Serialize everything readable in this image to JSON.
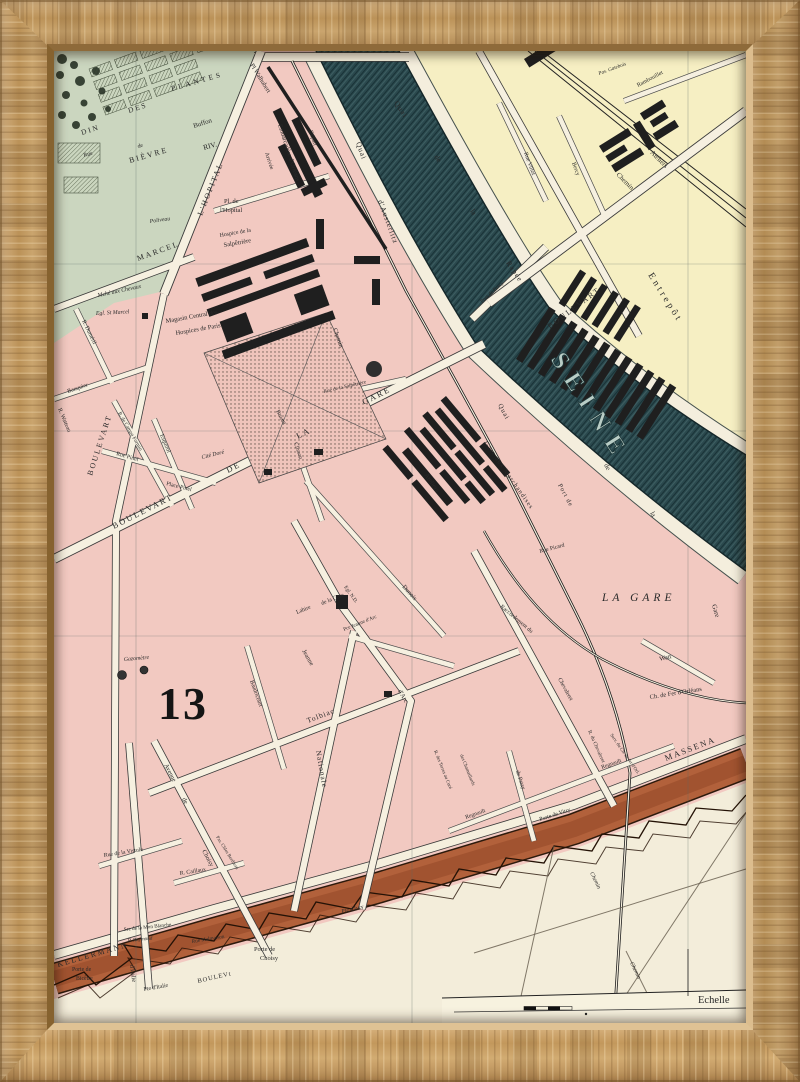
{
  "product": {
    "type": "framed antique map print",
    "frame_wood_color": "#c2a06c"
  },
  "map": {
    "colors": {
      "district_pink": "#f2c9c1",
      "garden_green": "#cbd6bf",
      "right_bank_yellow": "#f6efc3",
      "river_dark": "#2a484d",
      "street_cream": "#f6f0e0",
      "fortification_rust": "#b2613b",
      "zone_cream": "#f3edda",
      "building_black": "#1f1f1f"
    },
    "labels": {
      "din": "DIN",
      "des": "DES",
      "plantes": "PLANTES",
      "rue": "Rue",
      "de": "de",
      "la": "la",
      "buffon": "Buffon",
      "bievre": "BIÈVRE",
      "riv": "RIV.",
      "poliveau": "Poliveau",
      "marcel": "MARCEL",
      "egl_st_marcel": "Egl. St Marcel",
      "marche_chevaux": "Mché aux Chevaux",
      "pl_de": "Pl. de",
      "l_hopital": "l'Hopital",
      "bd_hopital": "L'HOPITAL",
      "pl_walhubert": "Pl Walhubert",
      "embarcadere": "Embarcadère d'Orléans",
      "depart": "Départ",
      "arrivee": "Arrivée",
      "quai": "Quai",
      "d_austerlitz": "d'Austerlitz",
      "chemin": "Chemin",
      "hospice_de_la": "Hospice de la",
      "salpetriere": "Salpêtrière",
      "magasin_central": "Magasin Central des",
      "hospices_paris": "Hospices de Paris",
      "rue_salpetriere": "Rue de la Salpêtrière",
      "bruant": "Bruant",
      "clisson": "Clisson",
      "dumeril": "R. Duméril",
      "banquier": "Banquier",
      "watteau": "R. Watteau",
      "boulevart": "BOULEVART",
      "pinel": "Rue Pinel",
      "place_pinel": "Place Pinel",
      "esquirol": "Esquirol",
      "campo_formio": "R. de Campo Formio",
      "cite_dore": "Cité Doré",
      "de_caps": "DE",
      "la_caps": "LA",
      "gare_caps": "GARE",
      "gazometre": "Gazomètre",
      "thirteen": "13",
      "tolbiac": "Tolbiac",
      "nationale": "Nationale",
      "jeanne": "Jeanne",
      "d_arc": "d'Arc",
      "lahire": "Lahire",
      "rue_de_la_gare": "de la Gare",
      "pce_jeanne": "Pce Jeanne d'Arc",
      "egl_nd": "Egl. N.D.",
      "dunois": "Dunois",
      "baudricourt": "Baudricourt",
      "ateliers": "Ateliers",
      "gare_marchandises": "Gare aux Marchandises",
      "rue_picard": "Rue Picard",
      "gare": "Gare",
      "port_de": "Port de",
      "seine": "SEINE",
      "pont_bercy": "Pont de Bercy",
      "rapee": "Rapée",
      "entrepot": "Entrepôt",
      "villot": "Rue Villot",
      "bercy": "Bercy",
      "rambouillet": "Rambouillet",
      "gatebois": "Pas. Gatebois",
      "la_gare": "LA GARE",
      "watt": "Watt",
      "raccordement": "Raccordement du",
      "ch_fer_orleans": "Ch. de Fer d'Orléans",
      "chevaleret": "Chevaleret",
      "r_du_chevaleret": "R. du Chevaleret",
      "serv_orleans": "Serv. du Ch. de fer d'Orl.",
      "terres_cure": "R. des Terres au Curé",
      "chamaillards": "des Chamaillards",
      "patay": "de Patay",
      "regnault": "Regnault",
      "massena": "MASSENA",
      "kellermann": "KELLERMANN",
      "porte_vitry": "Porte de Vitry",
      "pte_ivry": "Pte d'Ivry",
      "porte_de": "Porte de",
      "choisy": "Choisy",
      "avenue": "Avenue",
      "d_italie": "d'Italie",
      "pte_italie": "Pte d'Italie",
      "bicetre": "Bicêtre",
      "boulevt": "BOULEVt",
      "vistule": "Rue de la Vistule",
      "caillaux": "R. Caillaux",
      "bertheau": "Pas. Chles Bertheau",
      "malmaison": "Rue Malmaison",
      "maison_blanche": "Sre de la Mon Blanche",
      "raymond": "P. Raymond",
      "echelle": "Echelle"
    }
  }
}
